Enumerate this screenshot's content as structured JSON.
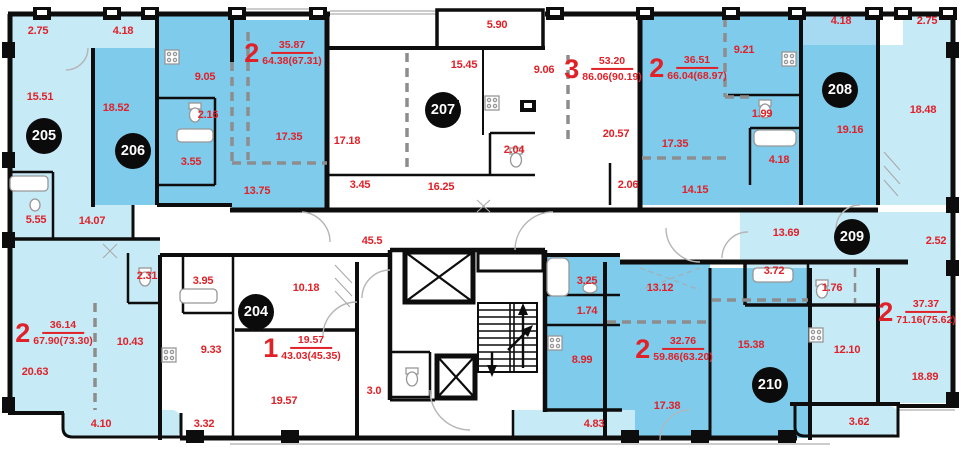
{
  "floor_plan": {
    "apartments": [
      {
        "number": "204",
        "rooms": "1",
        "living_area": "19.57",
        "total_area": "43.03(45.35)"
      },
      {
        "number": "205",
        "rooms": "2",
        "living_area": "36.14",
        "total_area": "67.90(73.30)"
      },
      {
        "number": "206",
        "rooms": "2",
        "living_area": "35.87",
        "total_area": "64.38(67.31)"
      },
      {
        "number": "207",
        "rooms": "3",
        "living_area": "53.20",
        "total_area": "86.06(90.19)"
      },
      {
        "number": "208",
        "rooms": "2",
        "living_area": "36.51",
        "total_area": "66.04(68.97)"
      },
      {
        "number": "209",
        "rooms": "2",
        "living_area": "37.37",
        "total_area": "71.16(75.62)"
      },
      {
        "number": "210",
        "rooms": "2",
        "living_area": "32.76",
        "total_area": "59.86(63.20)"
      }
    ],
    "room_labels": [
      {
        "area": "2.75",
        "apartment": "205"
      },
      {
        "area": "4.18",
        "apartment": "206"
      },
      {
        "area": "15.51",
        "apartment": "205"
      },
      {
        "area": "18.52",
        "apartment": "206"
      },
      {
        "area": "9.05",
        "apartment": "206"
      },
      {
        "area": "2.16",
        "apartment": "206"
      },
      {
        "area": "3.55",
        "apartment": "206"
      },
      {
        "area": "17.35",
        "apartment": "206"
      },
      {
        "area": "13.75",
        "apartment": "206"
      },
      {
        "area": "17.18",
        "apartment": "207"
      },
      {
        "area": "3.45",
        "apartment": "207"
      },
      {
        "area": "16.25",
        "apartment": "207"
      },
      {
        "area": "15.45",
        "apartment": "207"
      },
      {
        "area": "5.90",
        "apartment": "207"
      },
      {
        "area": "9.06",
        "apartment": "207"
      },
      {
        "area": "2.04",
        "apartment": "207"
      },
      {
        "area": "20.57",
        "apartment": "207"
      },
      {
        "area": "2.06",
        "apartment": "207"
      },
      {
        "area": "9.21",
        "apartment": "208"
      },
      {
        "area": "17.35",
        "apartment": "208"
      },
      {
        "area": "1.99",
        "apartment": "208"
      },
      {
        "area": "4.18",
        "apartment": "208"
      },
      {
        "area": "14.15",
        "apartment": "208"
      },
      {
        "area": "19.16",
        "apartment": "208"
      },
      {
        "area": "4.18",
        "apartment": "208"
      },
      {
        "area": "2.75",
        "apartment": "209"
      },
      {
        "area": "18.48",
        "apartment": "209"
      },
      {
        "area": "13.69",
        "apartment": "209"
      },
      {
        "area": "2.52",
        "apartment": "209"
      },
      {
        "area": "3.72",
        "apartment": "209"
      },
      {
        "area": "1.76",
        "apartment": "209"
      },
      {
        "area": "12.10",
        "apartment": "209"
      },
      {
        "area": "18.89",
        "apartment": "209"
      },
      {
        "area": "3.62",
        "apartment": "209"
      },
      {
        "area": "13.12",
        "apartment": "210"
      },
      {
        "area": "15.38",
        "apartment": "210"
      },
      {
        "area": "17.38",
        "apartment": "210"
      },
      {
        "area": "3.25",
        "apartment": "210"
      },
      {
        "area": "1.74",
        "apartment": "210"
      },
      {
        "area": "8.99",
        "apartment": "210"
      },
      {
        "area": "4.83",
        "apartment": "210"
      },
      {
        "area": "45.5",
        "apartment": "common-corridor"
      },
      {
        "area": "3.0",
        "apartment": "common-corridor"
      },
      {
        "area": "10.18",
        "apartment": "204"
      },
      {
        "area": "19.57",
        "apartment": "204"
      },
      {
        "area": "9.33",
        "apartment": "204"
      },
      {
        "area": "3.32",
        "apartment": "204"
      },
      {
        "area": "3.95",
        "apartment": "204"
      },
      {
        "area": "2.31",
        "apartment": "205"
      },
      {
        "area": "20.63",
        "apartment": "205"
      },
      {
        "area": "10.43",
        "apartment": "205"
      },
      {
        "area": "4.10",
        "apartment": "205"
      },
      {
        "area": "5.55",
        "apartment": "205"
      },
      {
        "area": "14.07",
        "apartment": "205"
      }
    ],
    "colors": {
      "wall": "#0d0d0d",
      "room_medium_blue": "#7fcbec",
      "room_pale_blue": "#c7eaf7",
      "balcony_light_blue": "#a6d9f2",
      "label_red": "#e02128",
      "apartment_badge": "#0b0b0b"
    }
  }
}
